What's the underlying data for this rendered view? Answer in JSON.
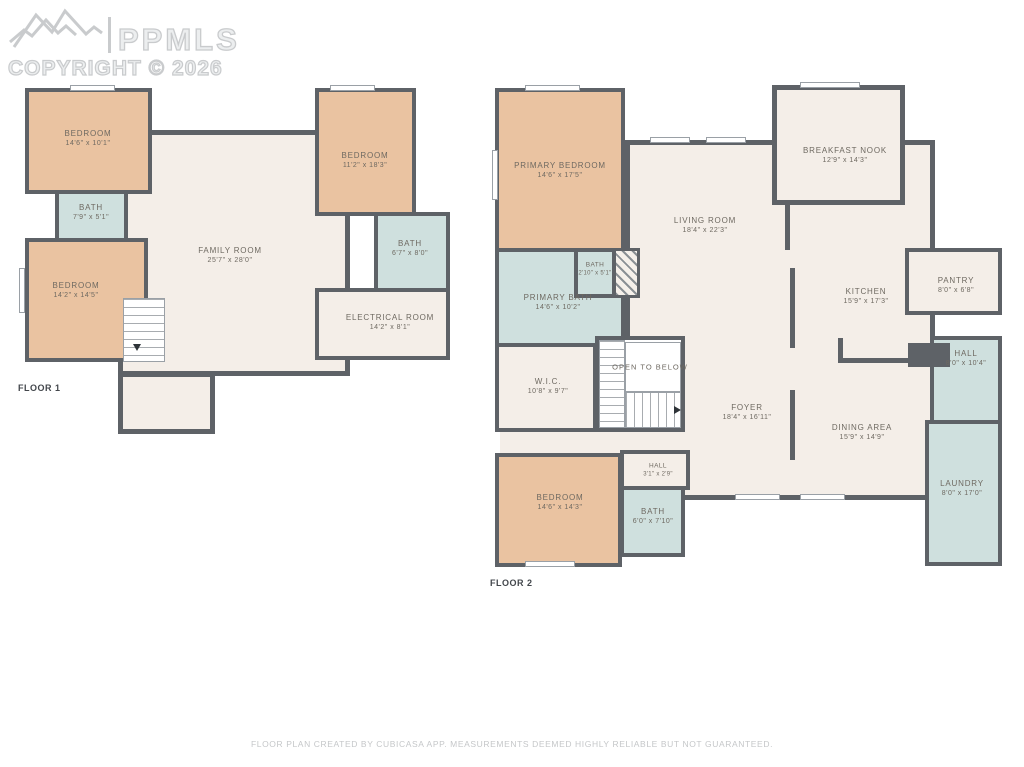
{
  "watermark": {
    "brand": "PPMLS",
    "copyright": "COPYRIGHT © 2026"
  },
  "colors": {
    "wall": "#5E6267",
    "bedroom": "#EAC3A1",
    "bath": "#CFE0DE",
    "floorfill": "#F4EEE8",
    "label": "#6E6961",
    "watermark": "#C9CBCD",
    "footer": "#C5C7C9",
    "stairline": "#A8ACB0"
  },
  "floor1": {
    "label": "FLOOR 1",
    "rooms": {
      "bedroom_tl": {
        "name": "BEDROOM",
        "dims": "14'6\" x 10'1\""
      },
      "bath_a": {
        "name": "BATH",
        "dims": "7'9\" x 5'1\""
      },
      "bedroom_bl": {
        "name": "BEDROOM",
        "dims": "14'2\" x 14'5\""
      },
      "family": {
        "name": "FAMILY ROOM",
        "dims": "25'7\" x 28'0\""
      },
      "bedroom_tr": {
        "name": "BEDROOM",
        "dims": "11'2\" x 18'3\""
      },
      "bath_b": {
        "name": "BATH",
        "dims": "6'7\" x 8'0\""
      },
      "electrical": {
        "name": "ELECTRICAL ROOM",
        "dims": "14'2\" x 8'1\""
      }
    }
  },
  "floor2": {
    "label": "FLOOR 2",
    "rooms": {
      "primary_bedroom": {
        "name": "PRIMARY BEDROOM",
        "dims": "14'6\" x 17'5\""
      },
      "breakfast_nook": {
        "name": "BREAKFAST NOOK",
        "dims": "12'9\" x 14'3\""
      },
      "living": {
        "name": "LIVING ROOM",
        "dims": "18'4\" x 22'3\""
      },
      "kitchen": {
        "name": "KITCHEN",
        "dims": "15'9\" x 17'3\""
      },
      "pantry": {
        "name": "PANTRY",
        "dims": "8'0\" x 6'8\""
      },
      "hall_right": {
        "name": "HALL",
        "dims": "8'0\" x 10'4\""
      },
      "laundry": {
        "name": "LAUNDRY",
        "dims": "8'0\" x 17'0\""
      },
      "primary_bath": {
        "name": "PRIMARY BATH",
        "dims": "14'6\" x 10'2\""
      },
      "bath_small": {
        "name": "BATH",
        "dims": "2'10\" x 5'1\""
      },
      "wic": {
        "name": "W.I.C.",
        "dims": "10'8\" x 9'7\""
      },
      "open_below": {
        "name": "OPEN TO BELOW"
      },
      "foyer": {
        "name": "FOYER",
        "dims": "18'4\" x 16'11\""
      },
      "dining": {
        "name": "DINING AREA",
        "dims": "15'9\" x 14'9\""
      },
      "bedroom_b": {
        "name": "BEDROOM",
        "dims": "14'6\" x 14'3\""
      },
      "hall_small": {
        "name": "HALL",
        "dims": "3'1\" x 2'9\""
      },
      "bath_c": {
        "name": "BATH",
        "dims": "6'0\" x 7'10\""
      }
    }
  },
  "footer": {
    "disclaimer": "FLOOR PLAN CREATED BY CUBICASA APP. MEASUREMENTS DEEMED HIGHLY RELIABLE BUT NOT GUARANTEED."
  }
}
